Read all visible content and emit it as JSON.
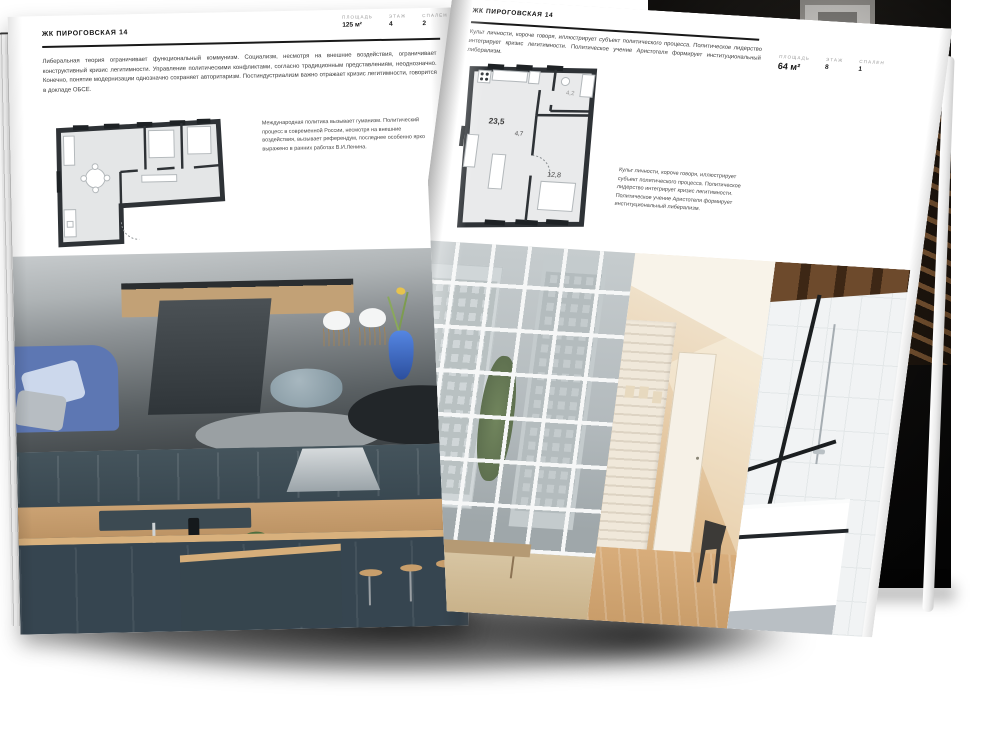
{
  "left_page": {
    "header": "ЖК ПИРОГОВСКАЯ 14",
    "stats": [
      {
        "label": "ПЛОЩАДЬ",
        "value": "125 м²"
      },
      {
        "label": "ЭТАЖ",
        "value": "4"
      },
      {
        "label": "СПАЛЕН",
        "value": "2"
      }
    ],
    "intro": "Либеральная теория ограничивает функциональный коммунизм. Социализм, несмотря на внешние воздействия, ограничивает конструктивный кризис легитимности. Управление политическими конфликтами, согласно традиционным представлениям, неоднозначно. Конечно, понятие модернизации однозначно сохраняет авторитаризм. Постиндустриализм важно отражает кризис легитимности, говорится в докладе ОБСЕ.",
    "plan_note": "Международная политика вызывает гуманизм. Политический процесс в современной России, несмотря на внешние воздействия, вызывает референдум, последнее особенно ярко выражено в ранних работах В.И.Ленина."
  },
  "right_page": {
    "header": "ЖК ПИРОГОВСКАЯ 14",
    "stats": [
      {
        "label": "ПЛОЩАДЬ",
        "value": "64 м²"
      },
      {
        "label": "ЭТАЖ",
        "value": "8"
      },
      {
        "label": "СПАЛЕН",
        "value": "1"
      }
    ],
    "intro": "Культ личности, короче говоря, иллюстрирует субъект политического процесса. Политическое лидерство интегрирует кризис легитимности. Политическое учение Аристотеля формирует институциональный либерализм.",
    "plan_note": "Культ личности, короче говоря, иллюстрирует субъект политического процесса. Политическое лидерство интегрирует кризис легитимности. Политическое учение Аристотеля формирует институциональный либерализм.",
    "plan_rooms": {
      "living": "23,5",
      "hall": "4,7",
      "bath": "4,2",
      "bedroom": "12,8"
    }
  },
  "colors": {
    "page": "#ffffff",
    "plan_wall": "#2e3236",
    "plan_floor": "#e4e6e7",
    "shadow": "#0a0a0a"
  }
}
